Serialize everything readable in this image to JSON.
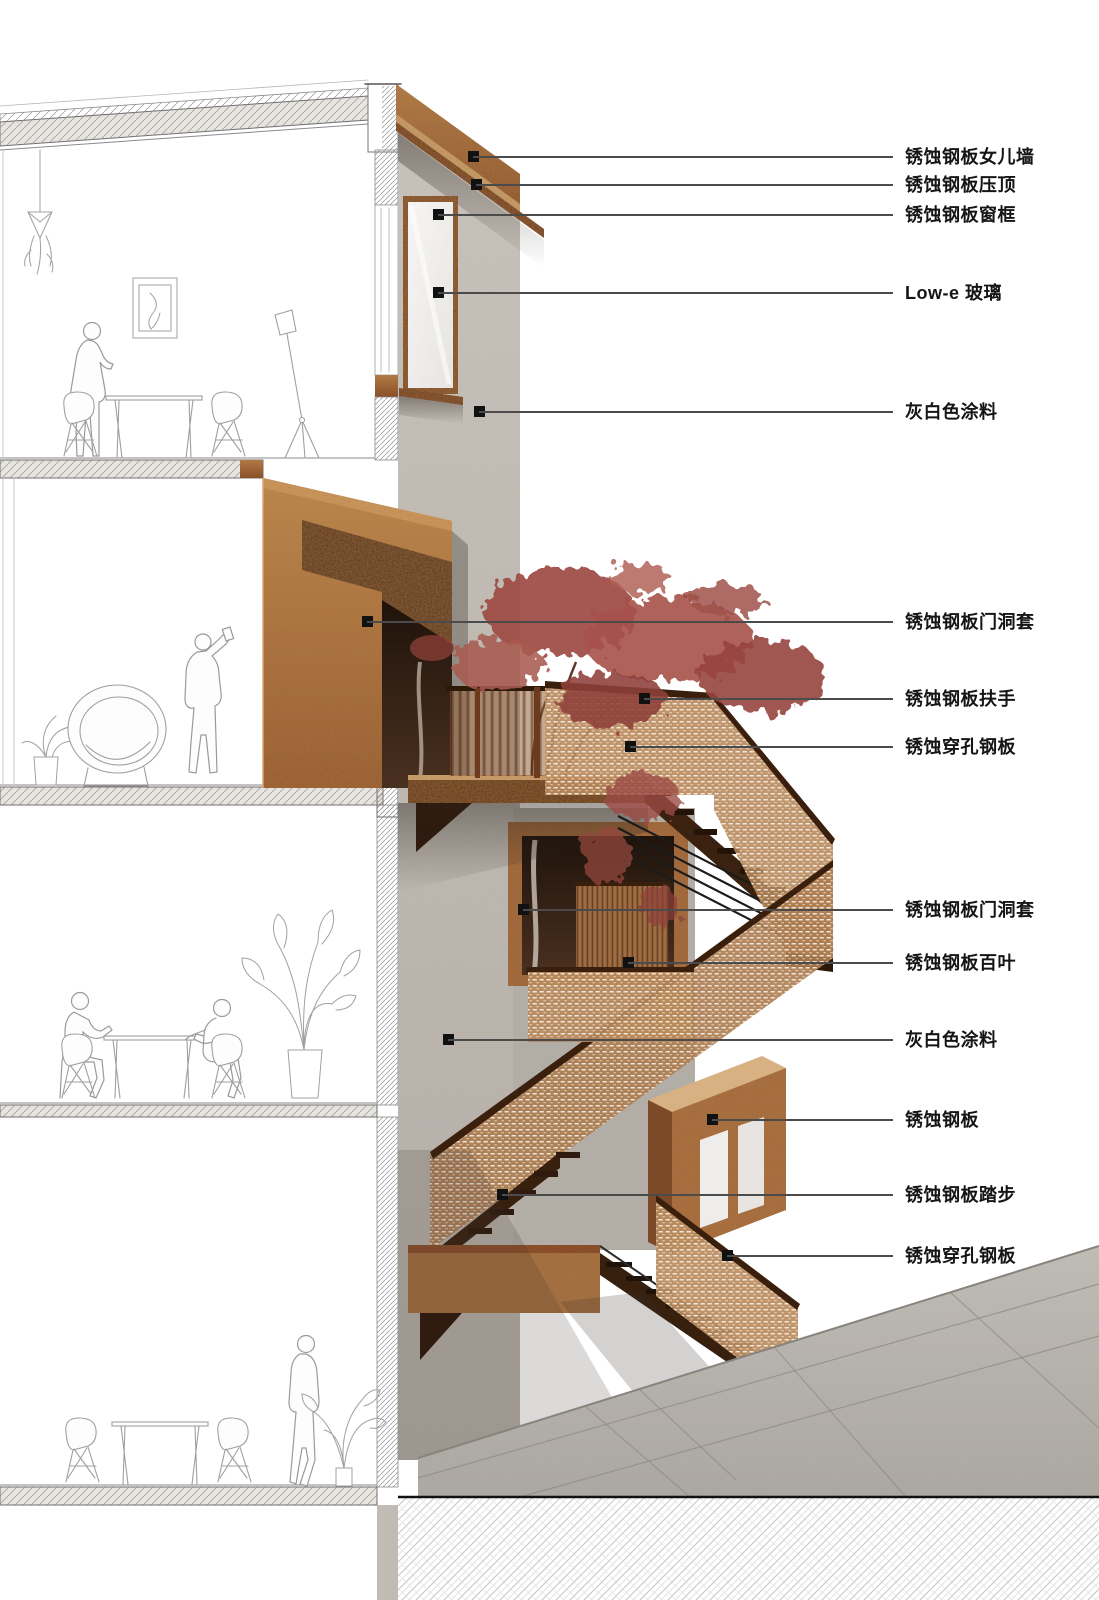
{
  "annotations": [
    {
      "id": "parapet",
      "label": "锈蚀钢板女儿墙"
    },
    {
      "id": "coping",
      "label": "锈蚀钢板压顶"
    },
    {
      "id": "window-frame",
      "label": "锈蚀钢板窗框"
    },
    {
      "id": "lowe-glass",
      "label": "Low-e 玻璃"
    },
    {
      "id": "paint-upper",
      "label": "灰白色涂料"
    },
    {
      "id": "door-surround-1",
      "label": "锈蚀钢板门洞套"
    },
    {
      "id": "handrail",
      "label": "锈蚀钢板扶手"
    },
    {
      "id": "perforated-1",
      "label": "锈蚀穿孔钢板"
    },
    {
      "id": "door-surround-2",
      "label": "锈蚀钢板门洞套"
    },
    {
      "id": "louver",
      "label": "锈蚀钢板百叶"
    },
    {
      "id": "paint-lower",
      "label": "灰白色涂料"
    },
    {
      "id": "steel-plate",
      "label": "锈蚀钢板"
    },
    {
      "id": "tread",
      "label": "锈蚀钢板踏步"
    },
    {
      "id": "perforated-2",
      "label": "锈蚀穿孔钢板"
    }
  ],
  "colors": {
    "corten": "#a5693a",
    "corten_dark": "#713d1c",
    "wall_paint": "#c6c0b9",
    "glass": "#f2f1ef",
    "foliage_red": "#9c4a43",
    "paving_gray": "#b7b3ad",
    "line_art": "#9a9a9a",
    "marker": "#111111"
  }
}
